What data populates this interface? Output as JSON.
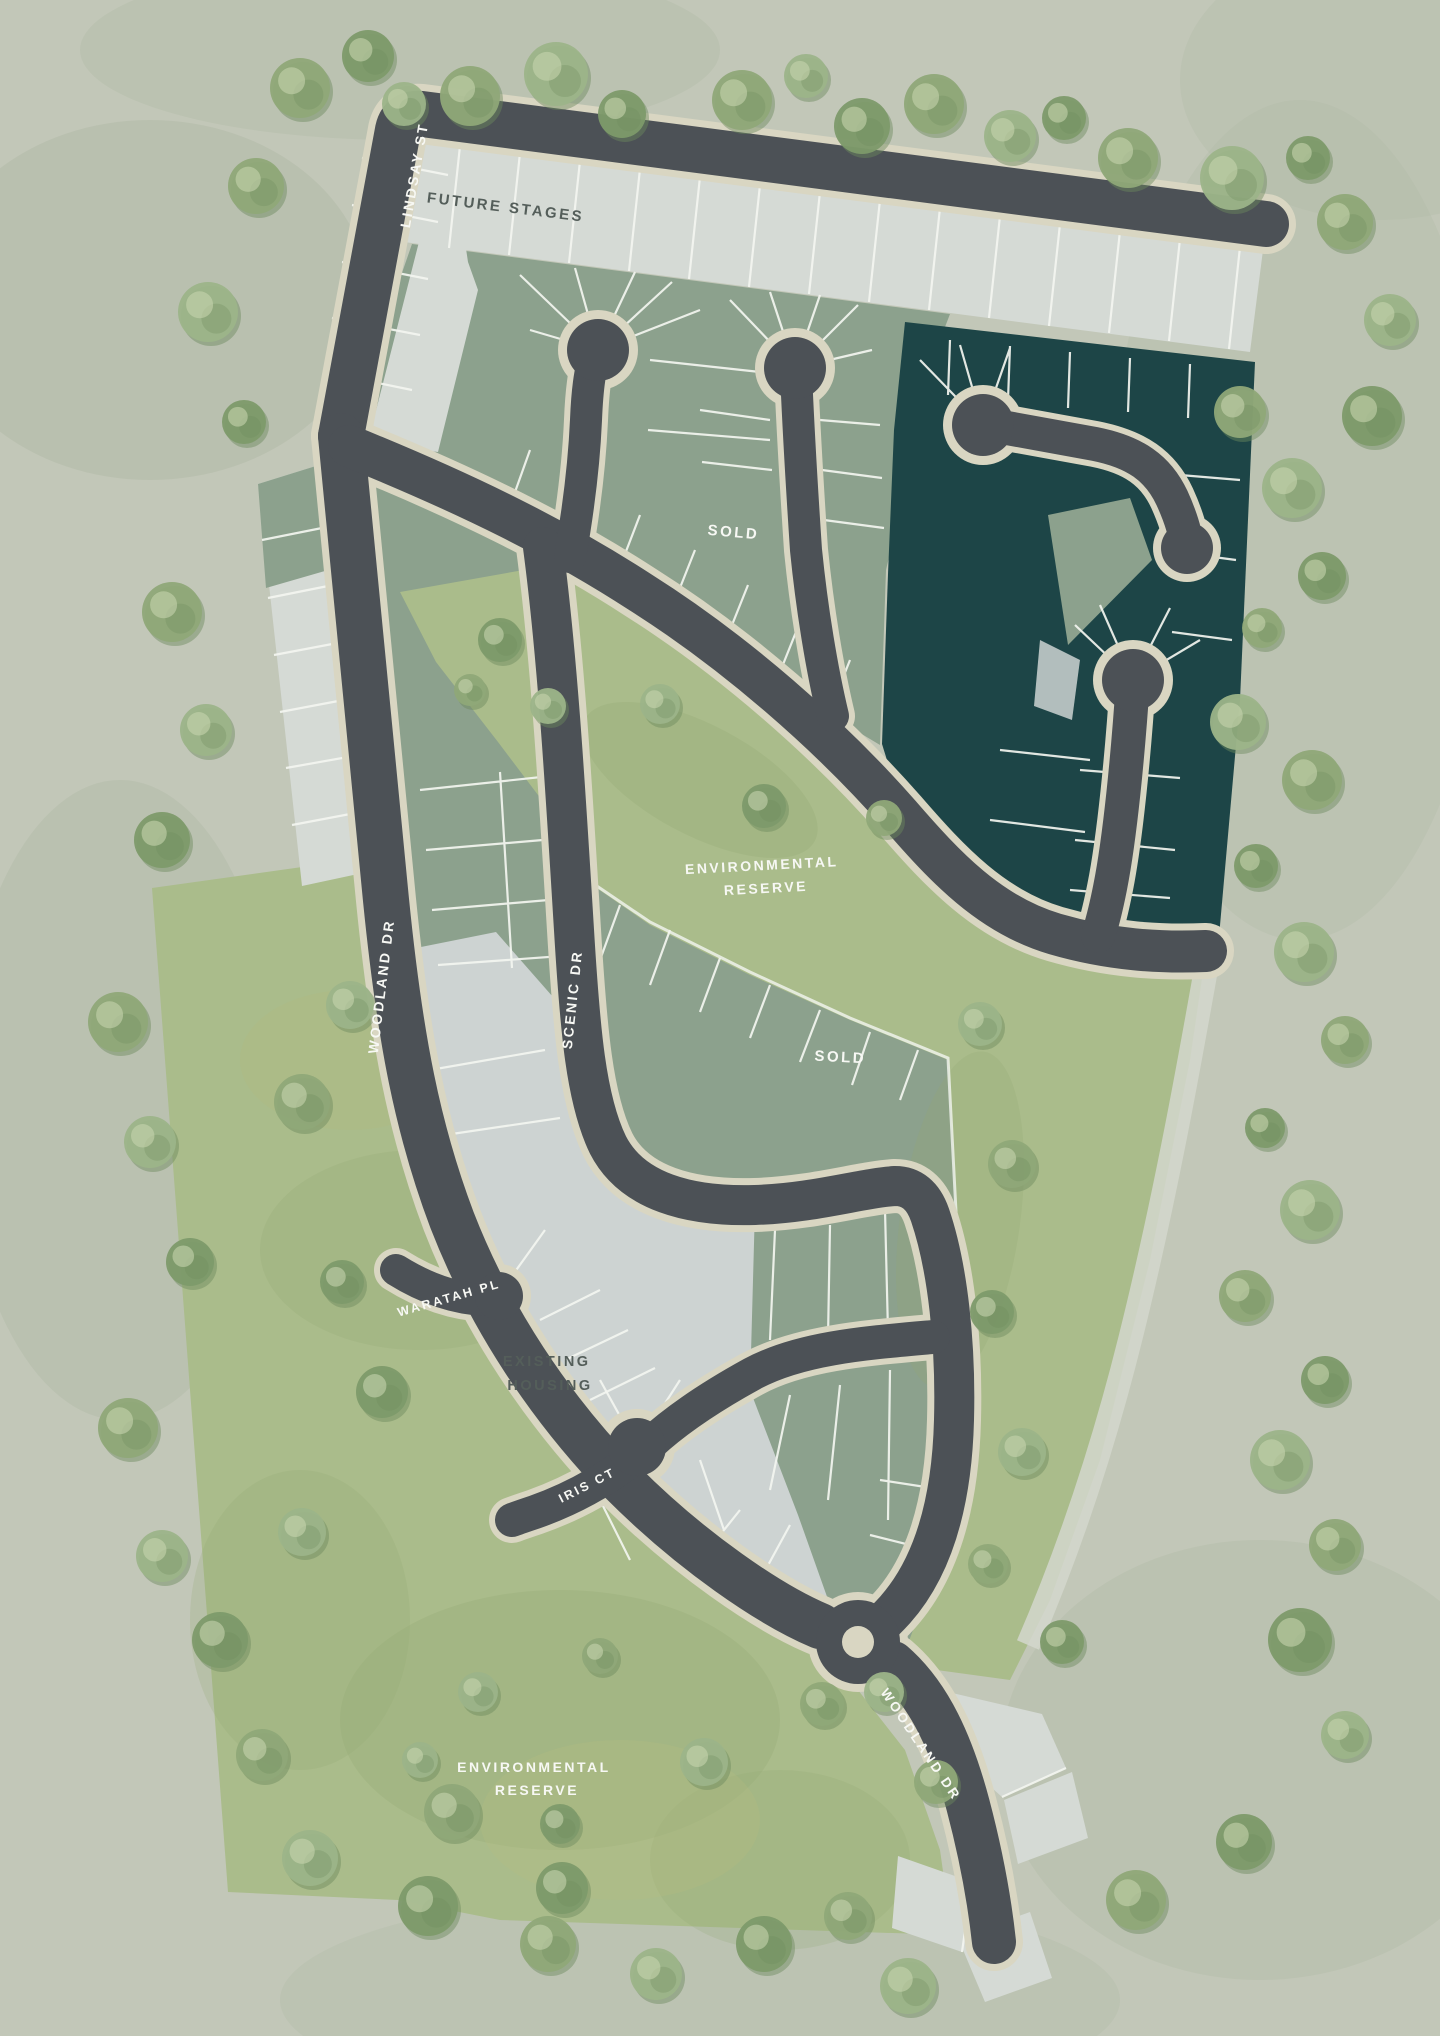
{
  "map": {
    "street_labels": {
      "lindsay_st": "LINDSAY ST",
      "woodland_dr_left": "WOODLAND DR",
      "woodland_dr_bottom": "WOODLAND DR",
      "scenic_dr": "SCENIC DR",
      "waratah_pl": "WARATAH PL",
      "iris_ct": "IRIS CT"
    },
    "region_labels": {
      "future_stages": "FUTURE STAGES",
      "sold_upper": "SOLD",
      "sold_lower": "SOLD",
      "env_reserve_upper_line1": "ENVIRONMENTAL",
      "env_reserve_upper_line2": "RESERVE",
      "env_reserve_lower_line1": "ENVIRONMENTAL",
      "env_reserve_lower_line2": "RESERVE",
      "existing_housing_line1": "EXISTING",
      "existing_housing_line2": "HOUSING"
    },
    "colors": {
      "bg": "#c2c7b8",
      "bgMottle": "#b0b9a4",
      "road": "#4c5156",
      "roadCasing": "#d9d6c2",
      "lotLight": "#d5dad5",
      "lotGray": "#cdd3d2",
      "sage": "#8ca18d",
      "teal": "#1d4547",
      "reserve": "#aabc8b",
      "reserveDark": "#92a973",
      "lotLine": "#f3f5f0",
      "labelLight": "#f7f8f4",
      "labelDark": "#545e5a",
      "treeA": "#8fa878",
      "treeB": "#7d9a6a",
      "treeC": "#9cb489",
      "treeShadow": "#6d8a5e",
      "treeHighlight": "#c6d4ae"
    },
    "trees": [
      [
        300,
        88,
        30,
        0
      ],
      [
        368,
        56,
        26,
        1
      ],
      [
        404,
        104,
        22,
        2
      ],
      [
        470,
        96,
        30,
        0
      ],
      [
        556,
        74,
        32,
        2
      ],
      [
        622,
        114,
        24,
        1
      ],
      [
        742,
        100,
        30,
        0
      ],
      [
        806,
        76,
        22,
        2
      ],
      [
        862,
        126,
        28,
        1
      ],
      [
        934,
        104,
        30,
        0
      ],
      [
        1010,
        136,
        26,
        2
      ],
      [
        1064,
        118,
        22,
        1
      ],
      [
        1128,
        158,
        30,
        0
      ],
      [
        1232,
        178,
        32,
        2
      ],
      [
        1308,
        158,
        22,
        1
      ],
      [
        1345,
        222,
        28,
        0
      ],
      [
        1390,
        320,
        26,
        2
      ],
      [
        1372,
        416,
        30,
        1
      ],
      [
        1240,
        412,
        26,
        0
      ],
      [
        1292,
        488,
        30,
        2
      ],
      [
        1322,
        576,
        24,
        1
      ],
      [
        1262,
        628,
        20,
        0
      ],
      [
        1238,
        722,
        28,
        2
      ],
      [
        1312,
        780,
        30,
        0
      ],
      [
        1256,
        866,
        22,
        1
      ],
      [
        1304,
        952,
        30,
        2
      ],
      [
        1345,
        1040,
        24,
        0
      ],
      [
        1265,
        1128,
        20,
        1
      ],
      [
        1310,
        1210,
        30,
        2
      ],
      [
        1245,
        1296,
        26,
        0
      ],
      [
        1325,
        1380,
        24,
        1
      ],
      [
        1280,
        1460,
        30,
        2
      ],
      [
        1335,
        1545,
        26,
        0
      ],
      [
        1300,
        1640,
        32,
        1
      ],
      [
        1345,
        1735,
        24,
        2
      ],
      [
        256,
        186,
        28,
        0
      ],
      [
        208,
        312,
        30,
        2
      ],
      [
        244,
        422,
        22,
        1
      ],
      [
        172,
        612,
        30,
        0
      ],
      [
        206,
        730,
        26,
        2
      ],
      [
        162,
        840,
        28,
        1
      ],
      [
        118,
        1022,
        30,
        0
      ],
      [
        150,
        1142,
        26,
        2
      ],
      [
        190,
        1262,
        24,
        1
      ],
      [
        128,
        1428,
        30,
        0
      ],
      [
        162,
        1556,
        26,
        2
      ],
      [
        220,
        1640,
        28,
        1
      ],
      [
        262,
        1755,
        26,
        0
      ],
      [
        310,
        1858,
        28,
        2
      ],
      [
        428,
        1906,
        30,
        1
      ],
      [
        548,
        1944,
        28,
        0
      ],
      [
        656,
        1974,
        26,
        2
      ],
      [
        764,
        1944,
        28,
        1
      ],
      [
        848,
        1916,
        24,
        0
      ],
      [
        908,
        1986,
        28,
        2
      ],
      [
        1136,
        1900,
        30,
        0
      ],
      [
        1244,
        1842,
        28,
        1
      ],
      [
        350,
        1005,
        24,
        2
      ],
      [
        302,
        1102,
        28,
        0
      ],
      [
        382,
        1392,
        26,
        1
      ],
      [
        302,
        1532,
        24,
        2
      ],
      [
        452,
        1812,
        28,
        0
      ],
      [
        562,
        1888,
        26,
        1
      ],
      [
        704,
        1762,
        24,
        2
      ],
      [
        822,
        1704,
        22,
        0
      ],
      [
        342,
        1282,
        22,
        1
      ],
      [
        478,
        1692,
        20,
        2
      ],
      [
        600,
        1656,
        18,
        0
      ],
      [
        500,
        640,
        22,
        1
      ],
      [
        548,
        706,
        18,
        2
      ],
      [
        470,
        690,
        16,
        0
      ],
      [
        660,
        704,
        20,
        2
      ],
      [
        764,
        806,
        22,
        1
      ],
      [
        884,
        818,
        18,
        0
      ],
      [
        980,
        1024,
        22,
        2
      ],
      [
        1012,
        1164,
        24,
        0
      ],
      [
        992,
        1312,
        22,
        1
      ],
      [
        1022,
        1452,
        24,
        2
      ],
      [
        988,
        1564,
        20,
        0
      ],
      [
        1062,
        1642,
        22,
        1
      ],
      [
        884,
        1692,
        20,
        2
      ],
      [
        936,
        1782,
        22,
        0
      ],
      [
        560,
        1824,
        20,
        1
      ],
      [
        420,
        1760,
        18,
        2
      ]
    ]
  }
}
